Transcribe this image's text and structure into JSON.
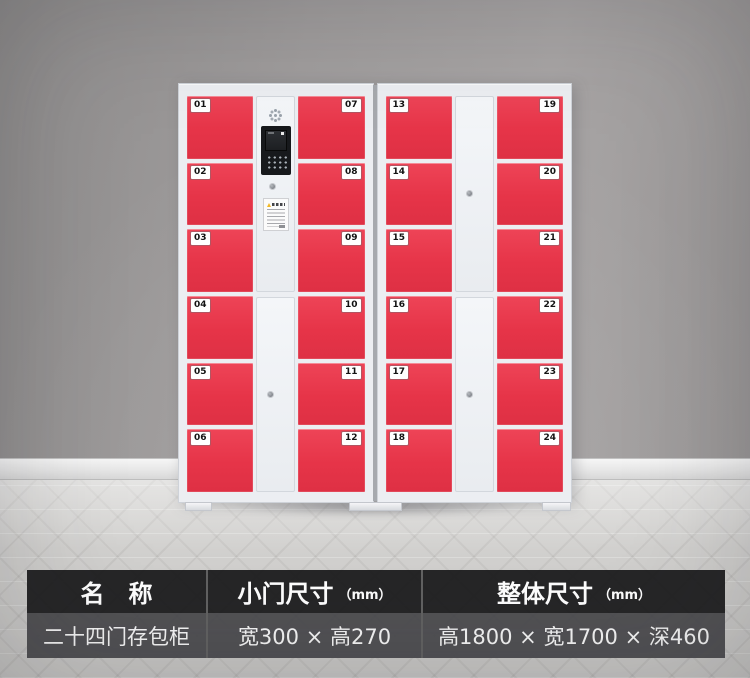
{
  "scene": {
    "wall_color": "#a09d9d",
    "baseboard_color": "#eeeeee",
    "floor_color": "#d6d5d3"
  },
  "cabinet": {
    "frame_color": "#eceef2",
    "door_color": "#e63448",
    "door_numbers": [
      "01",
      "02",
      "03",
      "04",
      "05",
      "06",
      "07",
      "08",
      "09",
      "10",
      "11",
      "12",
      "13",
      "14",
      "15",
      "16",
      "17",
      "18",
      "19",
      "20",
      "21",
      "22",
      "23",
      "24"
    ],
    "icons": [
      "speaker-grille",
      "control-terminal",
      "keyhole",
      "instruction-label"
    ]
  },
  "spec_table": {
    "header_bg": "#1c1c1e",
    "row_bg": "#48484b",
    "text_color": "#ffffff",
    "headers": [
      {
        "label": "名　称",
        "unit": ""
      },
      {
        "label": "小门尺寸",
        "unit": "（mm）"
      },
      {
        "label": "整体尺寸",
        "unit": "（mm）"
      }
    ],
    "values": [
      "二十四门存包柜",
      "宽300 × 高270",
      "高1800 × 宽1700 × 深460"
    ]
  }
}
